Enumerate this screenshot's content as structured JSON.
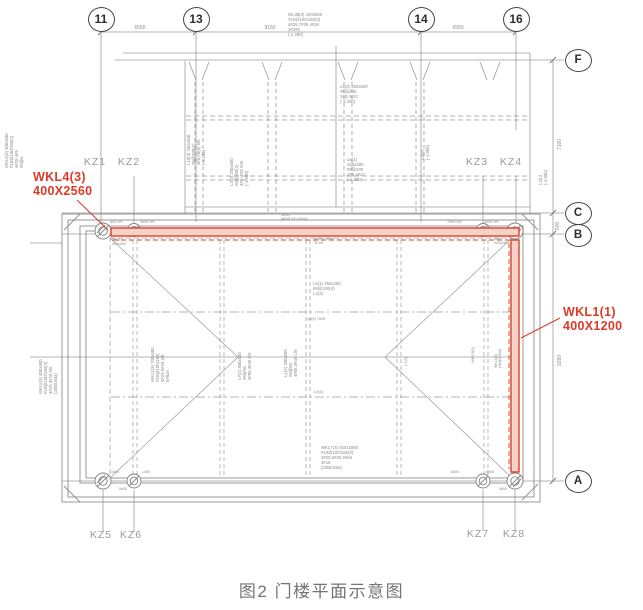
{
  "figure": {
    "caption": "图2 门楼平面示意图"
  },
  "colors": {
    "red": "#dd3a28",
    "line": "#999999",
    "dark": "#454545",
    "label": "#9a9a9a",
    "caption": "#747474"
  },
  "axis_bubbles": {
    "cols": [
      {
        "label": "11",
        "x": 101,
        "y": 19
      },
      {
        "label": "13",
        "x": 196,
        "y": 19
      },
      {
        "label": "14",
        "x": 421,
        "y": 19
      },
      {
        "label": "16",
        "x": 516,
        "y": 19
      }
    ],
    "rows": [
      {
        "label": "F",
        "x": 578,
        "y": 60
      },
      {
        "label": "C",
        "x": 578,
        "y": 213
      },
      {
        "label": "B",
        "x": 578,
        "y": 235
      },
      {
        "label": "A",
        "x": 578,
        "y": 481
      }
    ]
  },
  "dims": {
    "top": [
      {
        "t": "6550",
        "x": 140,
        "y": 25
      },
      {
        "t": "9160",
        "x": 270,
        "y": 25
      },
      {
        "t": "6550",
        "x": 458,
        "y": 25
      }
    ],
    "right": [
      {
        "t": "7100",
        "x": 557,
        "y": 150
      },
      {
        "t": "500",
        "x": 555,
        "y": 230
      },
      {
        "t": "9280",
        "x": 557,
        "y": 366
      }
    ]
  },
  "kz_labels": [
    {
      "t": "KZ1",
      "x": 95,
      "y": 162
    },
    {
      "t": "KZ2",
      "x": 129,
      "y": 162
    },
    {
      "t": "KZ3",
      "x": 477,
      "y": 162
    },
    {
      "t": "KZ4",
      "x": 511,
      "y": 162
    },
    {
      "t": "KZ5",
      "x": 101,
      "y": 535
    },
    {
      "t": "KZ6",
      "x": 131,
      "y": 535
    },
    {
      "t": "KZ7",
      "x": 478,
      "y": 534
    },
    {
      "t": "KZ8",
      "x": 514,
      "y": 534
    }
  ],
  "red_labels": [
    {
      "t": "WKL4(3)\n400X2560",
      "x": 33,
      "y": 170
    },
    {
      "t": "WKL1(1)\n400X1200",
      "x": 563,
      "y": 305
    }
  ],
  "annotations": [
    {
      "t": "WL39(3) 400x600\n#10@100/150(2)\n4#25,7#25 4#16\n3#2#6\n(-2.280)",
      "x": 288,
      "y": 12
    },
    {
      "t": "L6(3) 250x600\n#8@200\n2#8,4#22\n(-1.200)",
      "x": 340,
      "y": 84
    },
    {
      "t": "L5(1)\n250x600\n#8@200\n2#8,4#22\n(-1.200)",
      "x": 347,
      "y": 157
    },
    {
      "t": "#05 5/2",
      "x": 110,
      "y": 220,
      "s": 3.8
    },
    {
      "t": "3#05 5/2",
      "x": 140,
      "y": 220,
      "s": 3.8
    },
    {
      "t": "1#05\n[#8@100 (50a)]",
      "x": 281,
      "y": 213,
      "s": 3.8
    },
    {
      "t": "7#05 5/2",
      "x": 447,
      "y": 220,
      "s": 3.8
    },
    {
      "t": "2#05 5/2",
      "x": 484,
      "y": 220,
      "s": 3.8
    },
    {
      "t": "5#05\n400x260",
      "x": 112,
      "y": 238,
      "s": 3.6
    },
    {
      "t": "5#05\n400x260",
      "x": 494,
      "y": 237,
      "s": 3.6
    },
    {
      "t": "9#05 2/6/6b\n3C#2",
      "x": 314,
      "y": 237,
      "s": 3.8
    },
    {
      "t": "L5(1) 250x200\n#8@100(4)\nL4(2)",
      "x": 313,
      "y": 281
    },
    {
      "t": "L4(5) 7#05",
      "x": 307,
      "y": 317,
      "s": 3.8
    },
    {
      "t": "L5(2)",
      "x": 314,
      "y": 390,
      "s": 4
    },
    {
      "t": "WKL7(3) 400x2060\n#10@100/150(2)\n4#25,5#25 2/6/6\n3#16\n(2080.50a)",
      "x": 321,
      "y": 445
    },
    {
      "t": "1#05",
      "x": 111,
      "y": 470,
      "s": 3.5
    },
    {
      "t": "L#05",
      "x": 142,
      "y": 470,
      "s": 3.5
    },
    {
      "t": "5#05",
      "x": 119,
      "y": 487,
      "s": 3.5
    },
    {
      "t": "6#05",
      "x": 451,
      "y": 470,
      "s": 3.5
    },
    {
      "t": "6#05",
      "x": 486,
      "y": 470,
      "s": 3.5
    },
    {
      "t": "5#05",
      "x": 499,
      "y": 487,
      "s": 3.5
    },
    {
      "t": "L10(3) 250x300\n#8@200(2)\n4#5,#8(5) 5/5\n(-1.100)",
      "x": 186,
      "y": 165,
      "r": -90
    },
    {
      "t": "L3(3) 250x600\n#8@200(2)\n4#5+#25 #45\n(-1.200)",
      "x": 229,
      "y": 186,
      "r": -90
    },
    {
      "t": "L4(9)\n(-1.05b)",
      "x": 420,
      "y": 160,
      "r": -90
    },
    {
      "t": "L4(n)\n(-1.05b)",
      "x": 538,
      "y": 185,
      "r": -90
    },
    {
      "t": "WKL5(3) 400x500\n#10@100/150(2)\n4#25 4#5\n#6@6",
      "x": 4,
      "y": 168,
      "r": -90
    },
    {
      "t": "WKL5(3) 400x500\n#10@100/150(2)\n4#25,4#25 5/5\n(2080.50a)",
      "x": 38,
      "y": 394,
      "r": -90
    },
    {
      "t": "WKL2(3) 700x500\n#10@100(150)\n4#25,5#25 5/5\n5#6x6",
      "x": 150,
      "y": 382,
      "r": -90
    },
    {
      "t": "L#(2) 300x600\n#8@50\n3#05,3#45 5/5",
      "x": 237,
      "y": 380,
      "r": -90
    },
    {
      "t": "L1(9) 300x600\n#8@50\n4#05,3#45 L/6",
      "x": 283,
      "y": 377,
      "r": -90
    },
    {
      "t": "L7(3)",
      "x": 404,
      "y": 366,
      "r": -90,
      "s": 4
    },
    {
      "t": "WKL3(5)",
      "x": 471,
      "y": 363,
      "r": -90,
      "s": 4
    },
    {
      "t": "WKL1(5)\n[#8@# 50a]",
      "x": 494,
      "y": 368,
      "r": -90,
      "s": 3.6
    }
  ]
}
